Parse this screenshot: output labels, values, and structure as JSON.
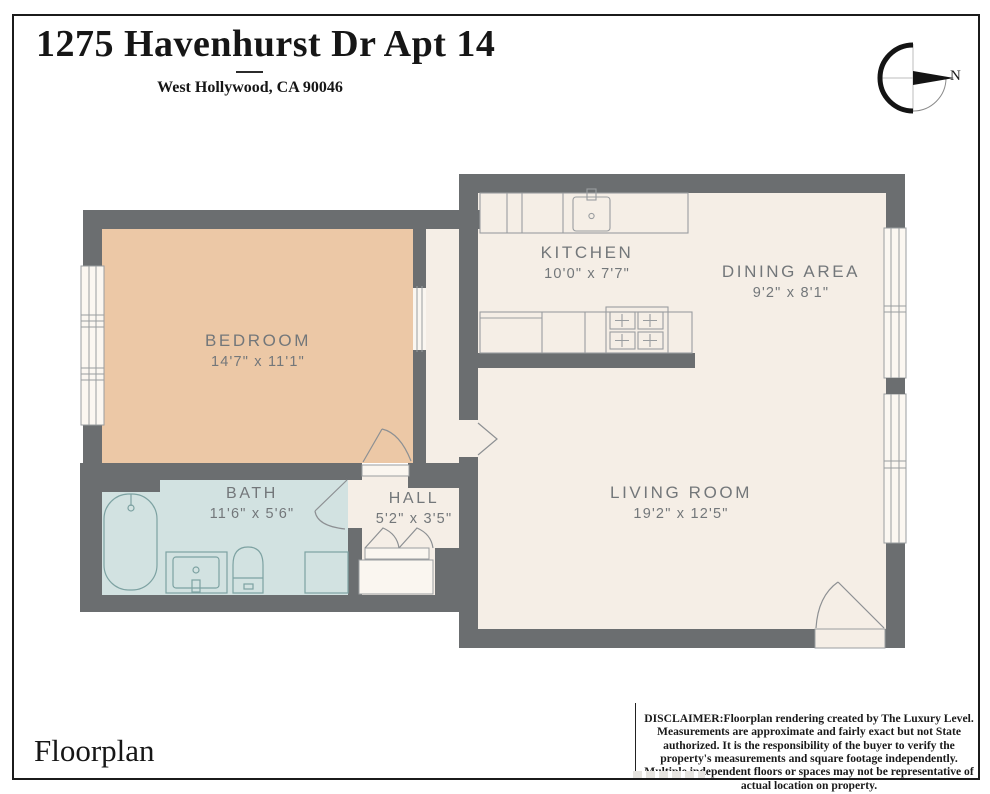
{
  "header": {
    "title": "1275 Havenhurst Dr Apt 14",
    "subtitle": "West Hollywood, CA 90046"
  },
  "compass": {
    "north_label": "N"
  },
  "rooms": [
    {
      "id": "bedroom",
      "name": "BEDROOM",
      "dims": "14'7\" x 11'1\""
    },
    {
      "id": "kitchen",
      "name": "KITCHEN",
      "dims": "10'0\" x 7'7\""
    },
    {
      "id": "dining-area",
      "name": "DINING AREA",
      "dims": "9'2\" x 8'1\""
    },
    {
      "id": "living-room",
      "name": "LIVING ROOM",
      "dims": "19'2\" x 12'5\""
    },
    {
      "id": "bath",
      "name": "BATH",
      "dims": "11'6\" x 5'6\""
    },
    {
      "id": "hall",
      "name": "HALL",
      "dims": "5'2\" x 3'5\""
    }
  ],
  "footer": {
    "label": "Floorplan",
    "disclaimer": "DISCLAIMER:Floorplan rendering created by The Luxury Level. Measurements are approximate and fairly exact but not State authorized. It is the responsibility of the buyer to verify the property's measurements and square footage independently. Multiple independent floors or spaces may not be representative of actual location on property."
  },
  "colors": {
    "wall": "#6b6e70",
    "floor": "#f5eee6",
    "bedroom_fill": "#ecc8a6",
    "bath_fill": "#d2e2e1",
    "fixture_line": "#9a9da0",
    "bath_fixture_line": "#7da2a2",
    "label_text": "#73777a"
  }
}
